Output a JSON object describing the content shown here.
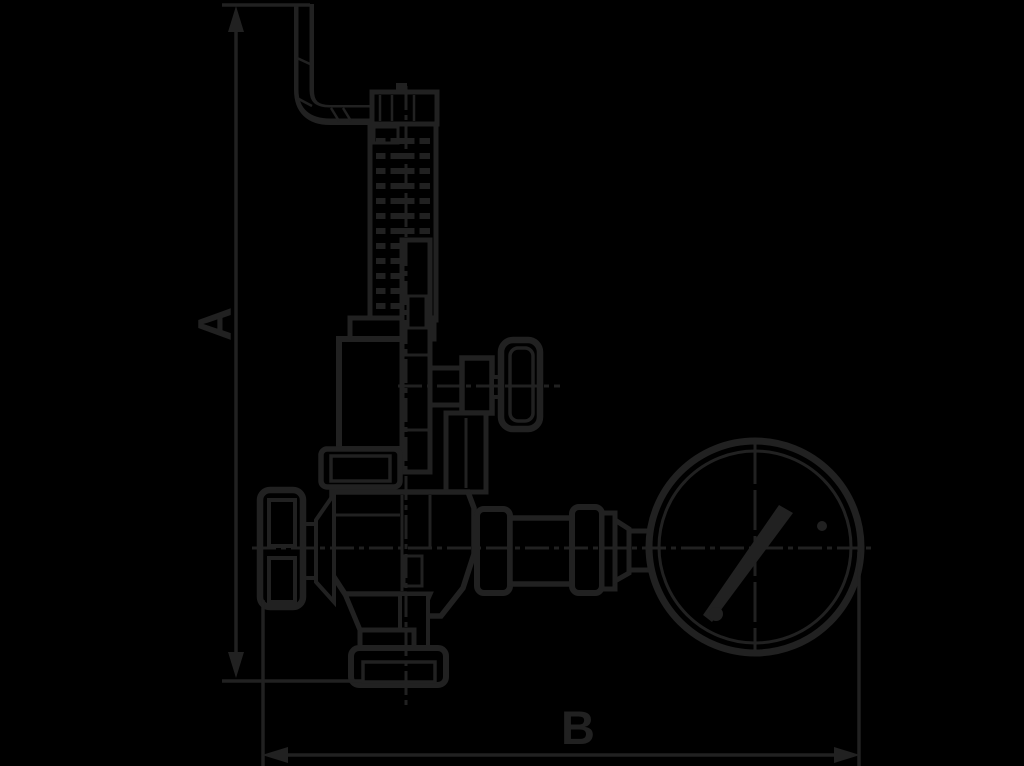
{
  "page": {
    "background_color": "#000000",
    "ink_color": "#212121"
  },
  "diagram": {
    "type": "technical-drawing",
    "subject": "relief valve with lever, spring bonnet, side hand knobs and connected pressure gauge",
    "dimension_labels": {
      "a": "A",
      "b": "B"
    }
  }
}
